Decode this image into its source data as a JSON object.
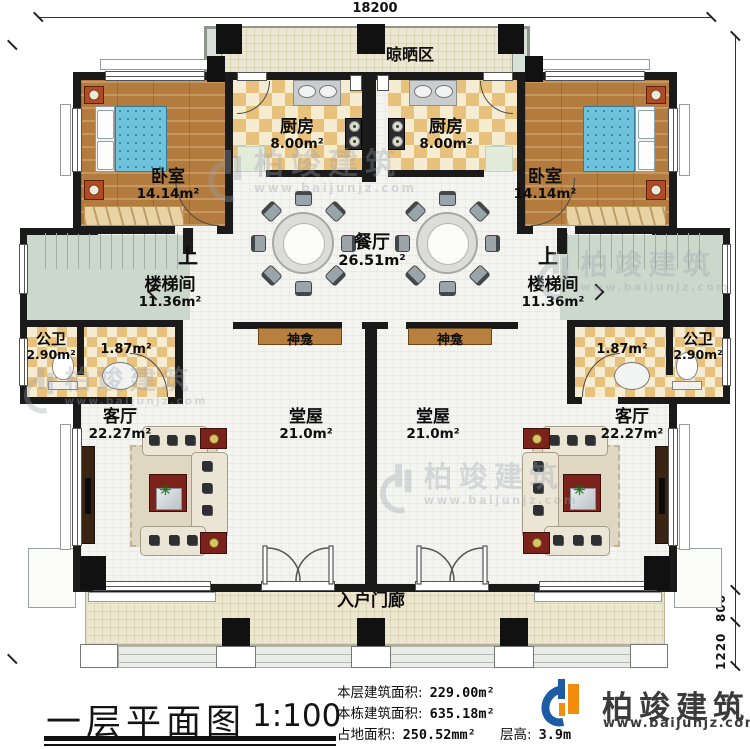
{
  "plan": {
    "title": "一层平面图",
    "scale": "1:100"
  },
  "dimensions": {
    "top_width": "18200",
    "right_height": "13820",
    "porch_depth": "800",
    "steps_depth": "1220"
  },
  "rooms": {
    "drying_area": {
      "name": "晾晒区"
    },
    "kitchen_left": {
      "name": "厨房",
      "area": "8.00m²"
    },
    "kitchen_right": {
      "name": "厨房",
      "area": "8.00m²"
    },
    "bedroom_left": {
      "name": "卧室",
      "area": "14.14m²"
    },
    "bedroom_right": {
      "name": "卧室",
      "area": "14.14m²"
    },
    "dining": {
      "name": "餐厅",
      "area": "26.51m²"
    },
    "stair_left": {
      "name": "楼梯间",
      "area": "11.36m²",
      "direction": "上"
    },
    "stair_right": {
      "name": "楼梯间",
      "area": "11.36m²",
      "direction": "上"
    },
    "bath_left": {
      "name": "公卫",
      "area": "2.90m²",
      "anteroom_area": "1.87m²"
    },
    "bath_right": {
      "name": "公卫",
      "area": "2.90m²",
      "anteroom_area": "1.87m²"
    },
    "shrine_left": {
      "name": "神龛"
    },
    "shrine_right": {
      "name": "神龛"
    },
    "hall_left": {
      "name": "堂屋",
      "area": "21.0m²"
    },
    "hall_right": {
      "name": "堂屋",
      "area": "21.0m²"
    },
    "living_left": {
      "name": "客厅",
      "area": "22.27m²"
    },
    "living_right": {
      "name": "客厅",
      "area": "22.27m²"
    },
    "porch": {
      "name": "入户门廊"
    }
  },
  "stats": {
    "floor_area_label": "本层建筑面积:",
    "floor_area_value": "229.00m²",
    "building_area_label": "本栋建筑面积:",
    "building_area_value": "635.18m²",
    "land_area_label": "占地面积:",
    "land_area_value": "250.52mm²",
    "floor_height_label": "层高:",
    "floor_height_value": "3.9m"
  },
  "branding": {
    "logo_text": "柏竣建筑",
    "logo_url": "www.baijunjz.com"
  },
  "watermark": {
    "text": "柏竣建筑",
    "url": "www.baijunjz.com"
  },
  "icons": {
    "plant": "✳"
  },
  "colors": {
    "wall": "#1a1a1a",
    "wood_floor": "#b37c3e",
    "tile_checker": "#e8c17d",
    "bed": "#6fc3dd",
    "stair": "#cdd8cd",
    "balcony_floor": "#ece7d2",
    "accent_red": "#7b231b",
    "logo_blue": "#1d5ba5",
    "logo_orange": "#f28c0d"
  }
}
